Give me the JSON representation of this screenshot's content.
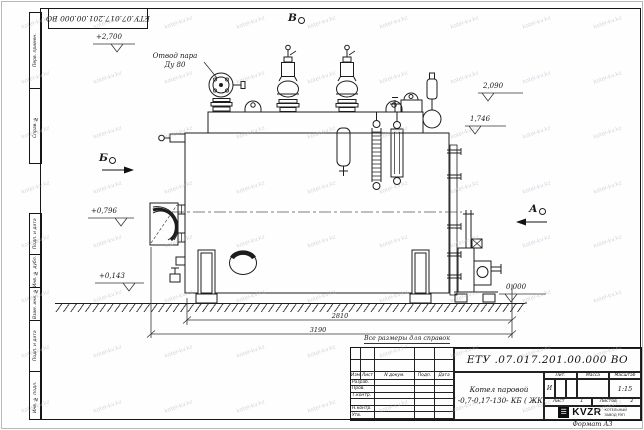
{
  "sheet": {
    "corner_stamp": "ЕТУ.07.017.201.00.000 ВО",
    "watermark": "kotel-kv.kz",
    "reference_note": "Все размеры для справок",
    "format_note": "Формат А3"
  },
  "side_stamps": {
    "perv_primen": "Перв. примен.",
    "sprav_no": "Справ. №",
    "podp_data1": "Подп. и дата",
    "inv_dubl": "Инв. № дубл.",
    "vzam_inv": "Взам. инв. №",
    "podp_data2": "Подп. и дата",
    "inv_podl": "Инв. № подл."
  },
  "annotations": {
    "steam_outlet_line1": "Отвод пара",
    "steam_outlet_line2": "Ду 80",
    "view_a": "А",
    "view_b": "Б",
    "view_v": "В",
    "elev_2700": "+2,700",
    "elev_2090": "2,090",
    "elev_1746": "1,746",
    "elev_0796": "+0,796",
    "elev_0143": "+0,143",
    "elev_0000": "0,000",
    "dim_2810": "2810",
    "dim_3190": "3190"
  },
  "title_block": {
    "doc_number": "ЕТУ .07.017.201.00.000  ВО",
    "product_name": "Котел паровой",
    "product_code": "Е -0,7-0,17-130- КБ ( ЖК )",
    "cols": {
      "izm": "Изм",
      "list": "Лист",
      "doc": "N докум.",
      "podp": "Подп.",
      "data": "Дата"
    },
    "rows": {
      "r0": "Разраб.",
      "r1": "Пров.",
      "r2": "Т.контр.",
      "r3": "",
      "r4": "Н.контр.",
      "r5": "Утв."
    },
    "lit_header": "Лит.",
    "mass_header": "Масса",
    "scale_header": "Масштаб",
    "lit_value": "И",
    "scale_value": "1:15",
    "sheet_label": "Лист",
    "sheet_value": "1",
    "sheets_label": "Листов",
    "sheets_value": "2",
    "company_logo": "KVZR",
    "company_line1": "КОТЕЛЬНЫЙ",
    "company_line2": "ЗАВОД РЭП"
  }
}
